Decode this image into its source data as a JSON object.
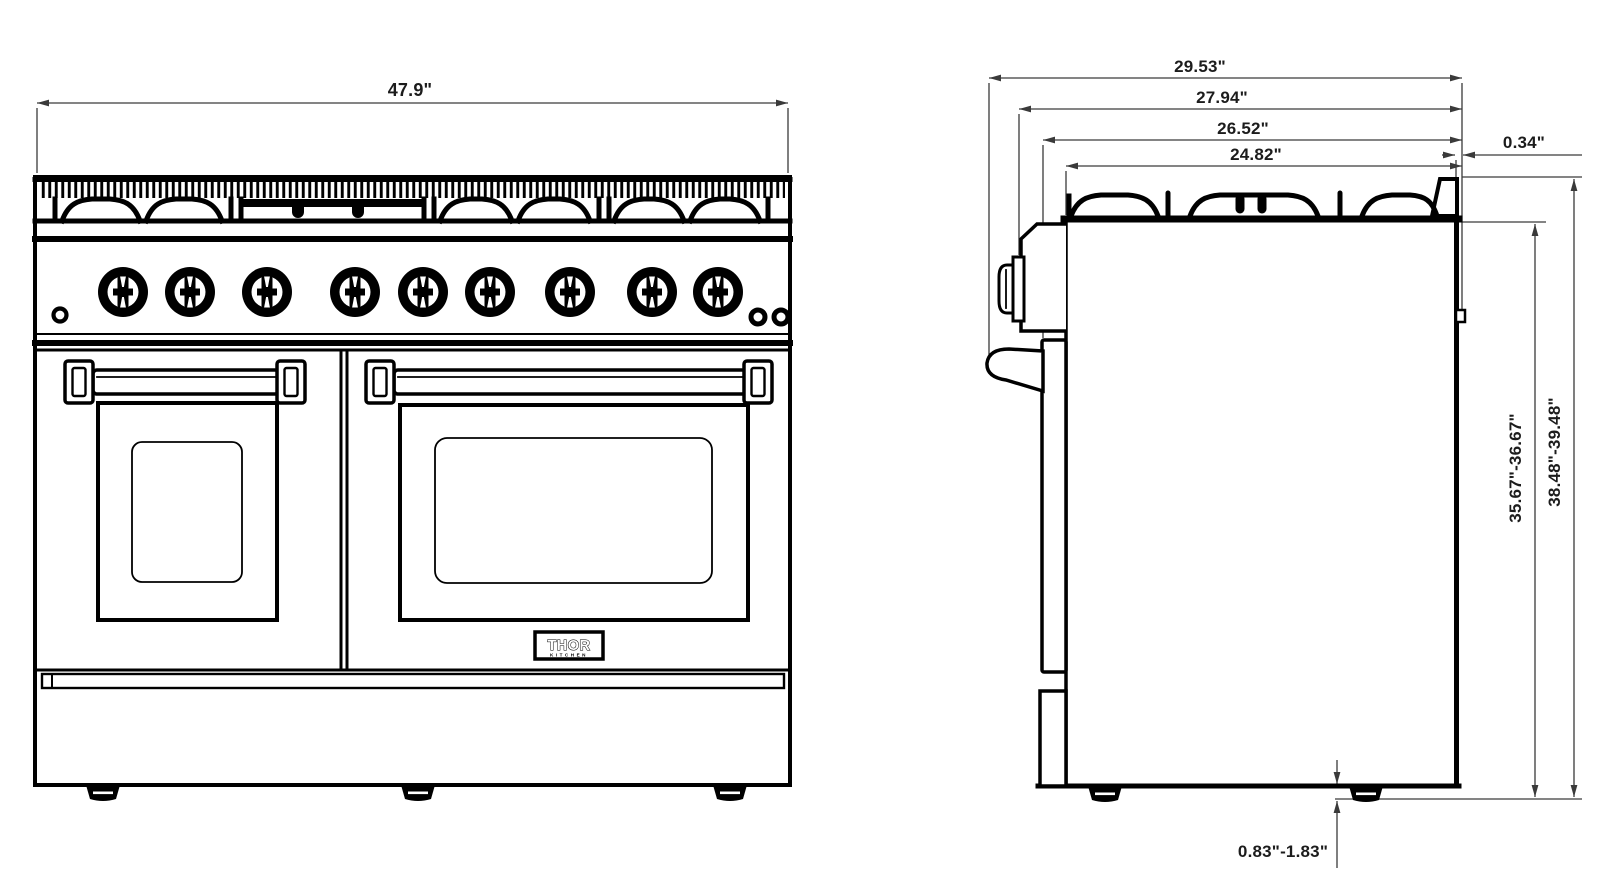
{
  "document": {
    "type": "appliance dimension drawing",
    "views": [
      "front elevation",
      "side elevation"
    ]
  },
  "front_view": {
    "width_dim": "47.9\"",
    "burner_knob_count": 9,
    "indicator_lights_left": 1,
    "indicator_lights_right": 2,
    "oven_doors": 2,
    "logo": {
      "brand": "THOR",
      "sub": "KITCHEN"
    }
  },
  "side_view": {
    "depth_dims": {
      "overall_with_handle": "29.53\"",
      "to_control_panel": "27.94\"",
      "to_door_front": "26.52\"",
      "body_depth": "24.82\""
    },
    "rear_trim_dim": "0.34\"",
    "height_to_cooktop_dim": "35.67\"-36.67\"",
    "overall_height_dim": "38.48\"-39.48\"",
    "leg_height_dim": "0.83\"-1.83\""
  },
  "colors": {
    "line": "#000000",
    "dim_line": "#3a3a3a",
    "text": "#1c1c1c",
    "background": "#ffffff"
  }
}
